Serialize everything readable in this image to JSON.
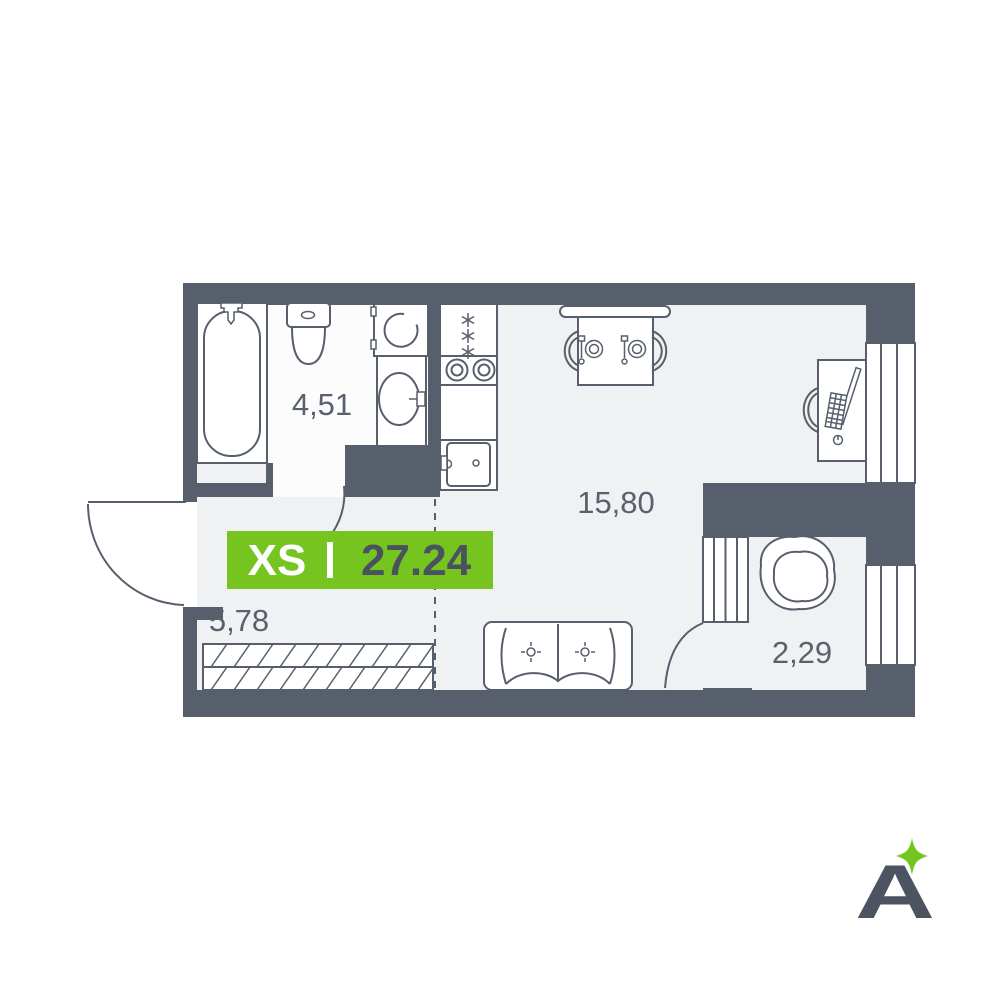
{
  "badge": {
    "size_label": "XS",
    "divider": "|",
    "total_area": "27.24"
  },
  "rooms": [
    {
      "name": "bathroom",
      "area": "4,51"
    },
    {
      "name": "kitchen-living-room",
      "area": "15,80"
    },
    {
      "name": "hallway",
      "area": "5,78"
    },
    {
      "name": "dressing-room",
      "area": "2,29"
    }
  ],
  "logo": {
    "letter": "A"
  },
  "colors": {
    "accent_green": "#76C420",
    "wall": "#575E6C",
    "floor": "#F0F1F2",
    "bathroom_floor": "#FCFCFD",
    "label_text": "#5A616E",
    "badge_number": "#4A5260"
  }
}
